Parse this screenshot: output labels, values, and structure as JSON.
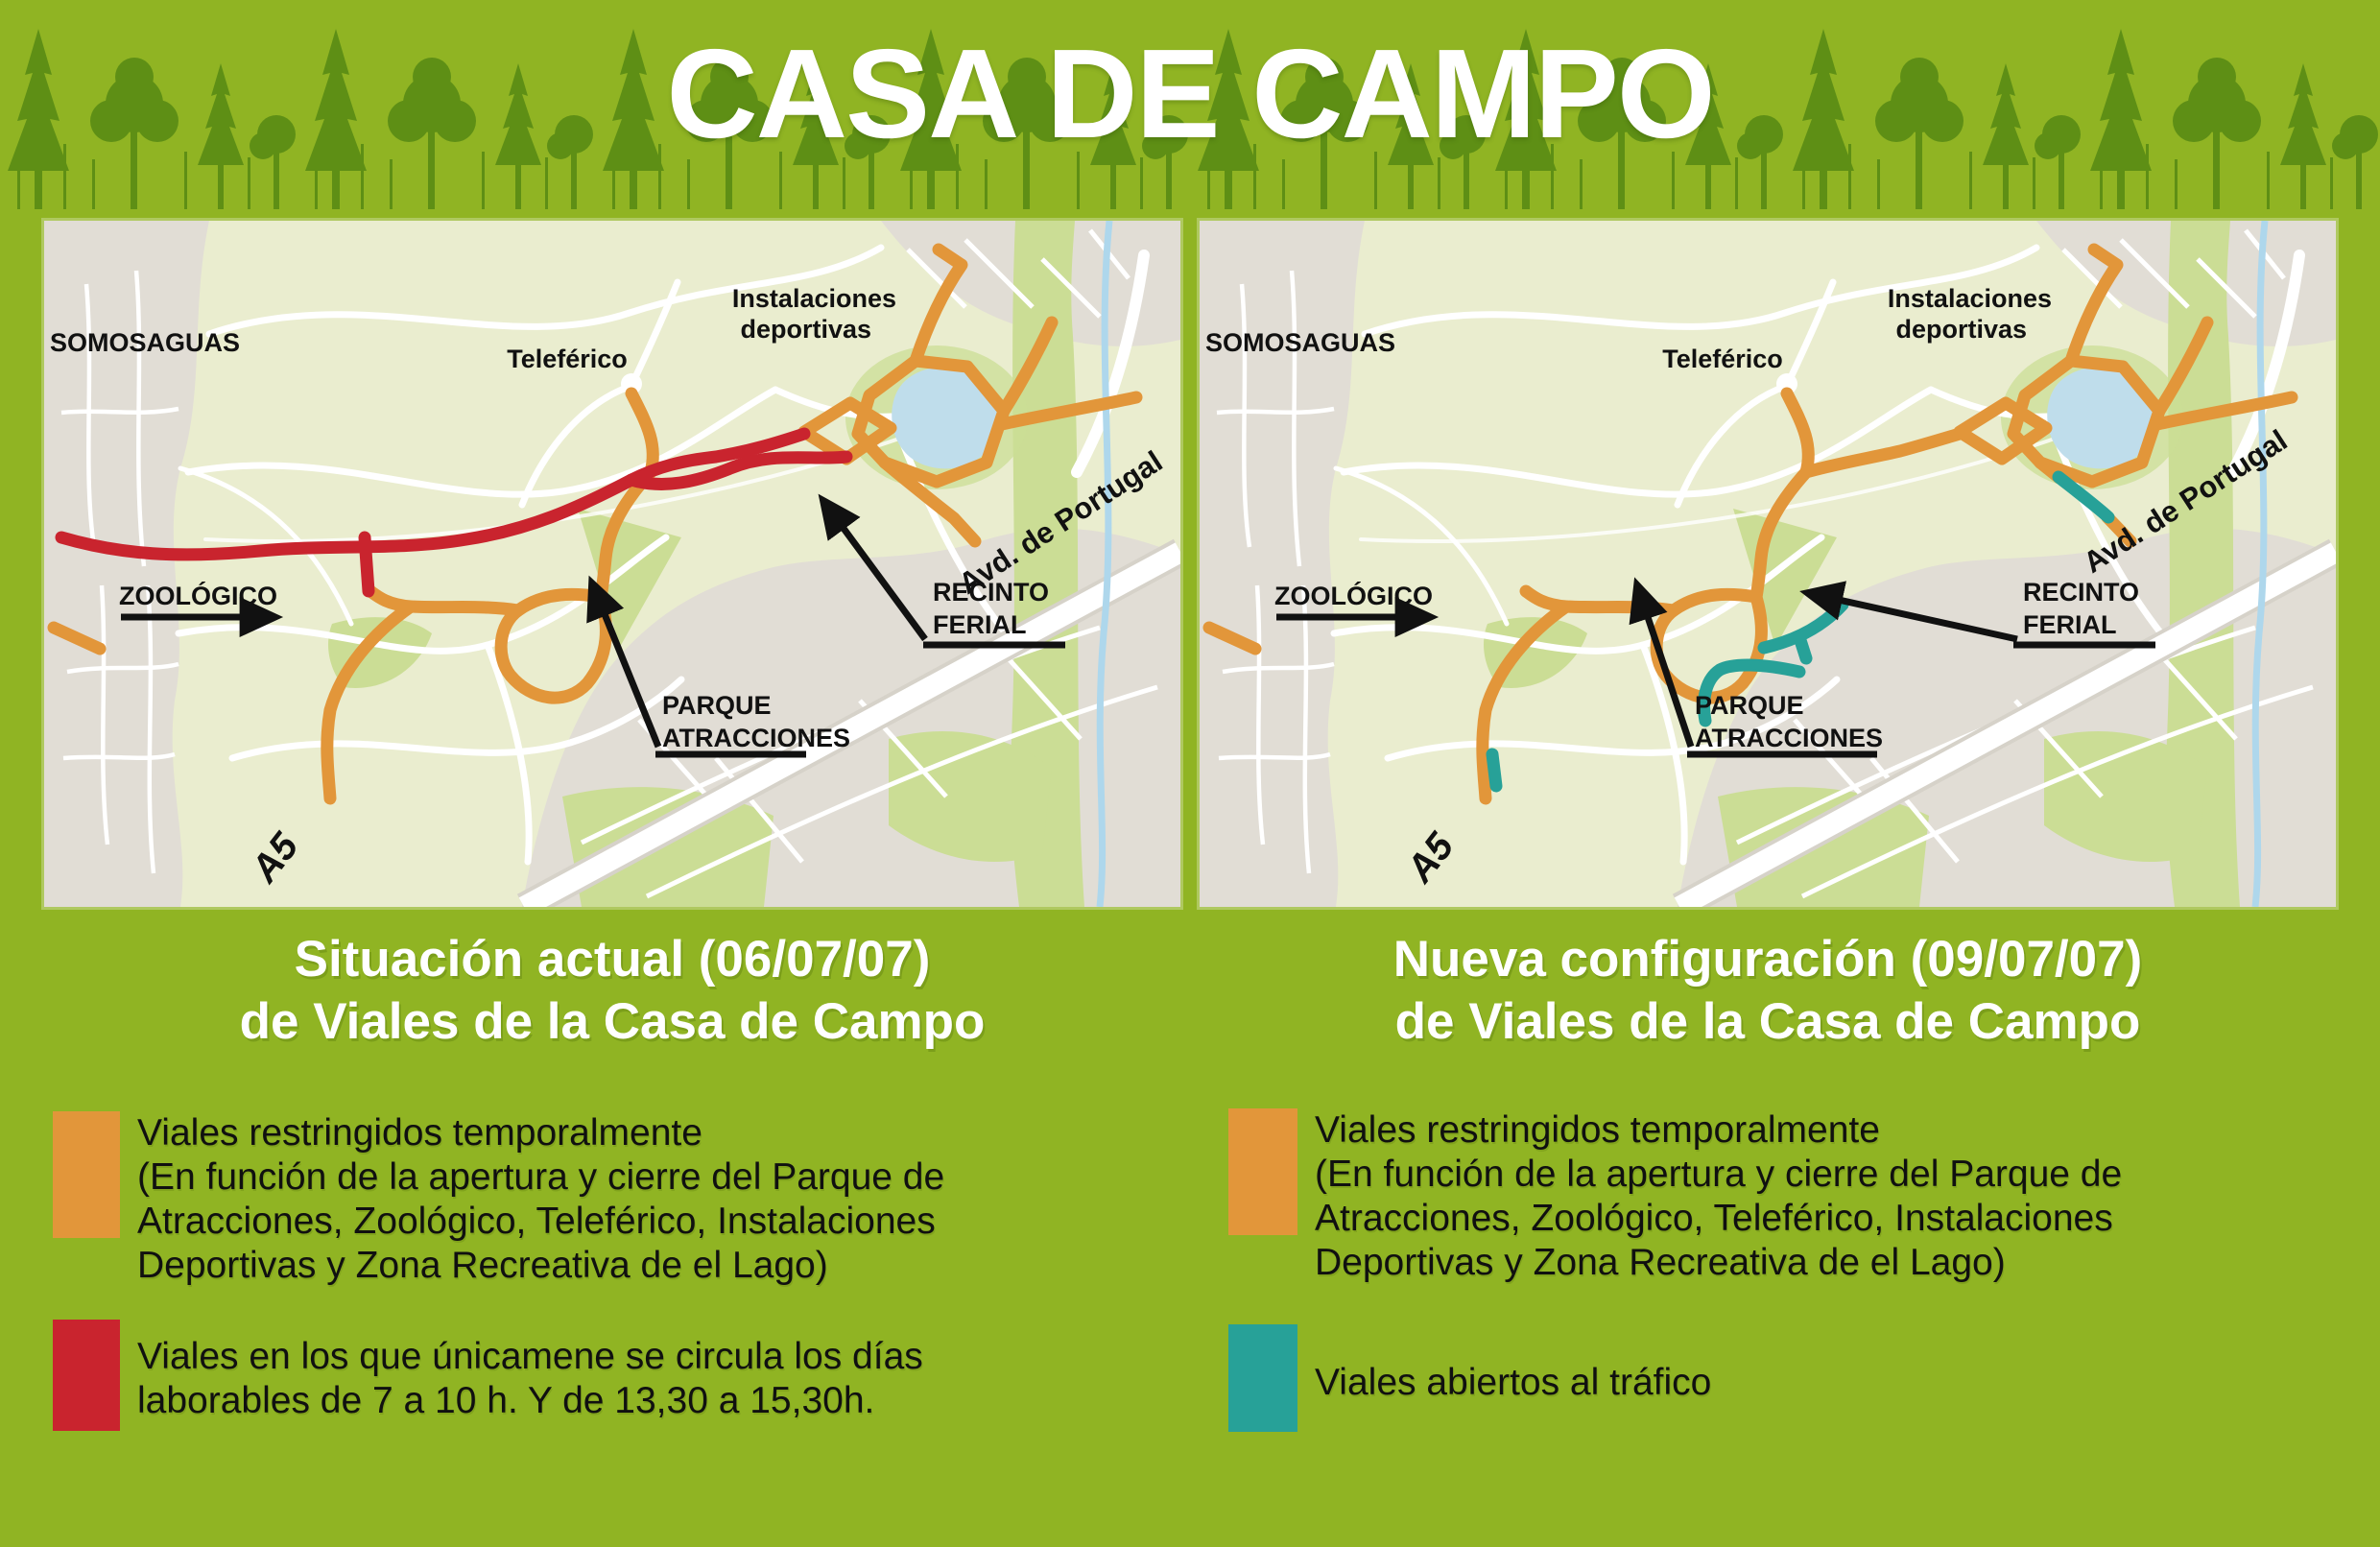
{
  "title": "CASA DE CAMPO",
  "colors": {
    "background_green": "#90B423",
    "tree_silhouette_green": "#5E8F15",
    "route_orange": "#E2963A",
    "route_red": "#C9242E",
    "route_teal": "#27A198",
    "map_park": "#EAEDCF",
    "map_urban_gray": "#E1DDD5",
    "lake_blue": "#BFDDEB"
  },
  "map_labels": {
    "somosaguas": "SOMOSAGUAS",
    "instalaciones_line1": "Instalaciones",
    "instalaciones_line2": "deportivas",
    "teleferico": "Teleférico",
    "avd_portugal": "Avd. de Portugal",
    "zoologico": "ZOOLÓGICO",
    "recinto_line1": "RECINTO",
    "recinto_line2": "FERIAL",
    "parque_line1": "PARQUE",
    "parque_line2": "ATRACCIONES",
    "a5": "A5"
  },
  "panels": [
    {
      "subtitle": [
        "Situación actual (06/07/07)",
        "de Viales de la Casa de Campo"
      ],
      "legend": [
        {
          "color": "#E2963A",
          "lines": [
            "Viales restringidos temporalmente",
            "(En función de la apertura y cierre del Parque de",
            "Atracciones, Zoológico,  Teleférico, Instalaciones",
            "Deportivas y Zona Recreativa de el Lago)"
          ]
        },
        {
          "color": "#C9242E",
          "lines": [
            "Viales en los que únicamene se circula los días",
            "laborables de 7 a 10 h. Y de 13,30 a 15,30h."
          ]
        }
      ]
    },
    {
      "subtitle": [
        "Nueva configuración (09/07/07)",
        "de Viales de la Casa de Campo"
      ],
      "legend": [
        {
          "color": "#E2963A",
          "lines": [
            "Viales restringidos temporalmente",
            "(En función de la apertura y cierre del Parque de",
            "Atracciones, Zoológico,  Teleférico, Instalaciones",
            "Deportivas y Zona Recreativa de el Lago)"
          ]
        },
        {
          "color": "#27A198",
          "lines": [
            "Viales abiertos al tráfico"
          ]
        }
      ]
    }
  ]
}
